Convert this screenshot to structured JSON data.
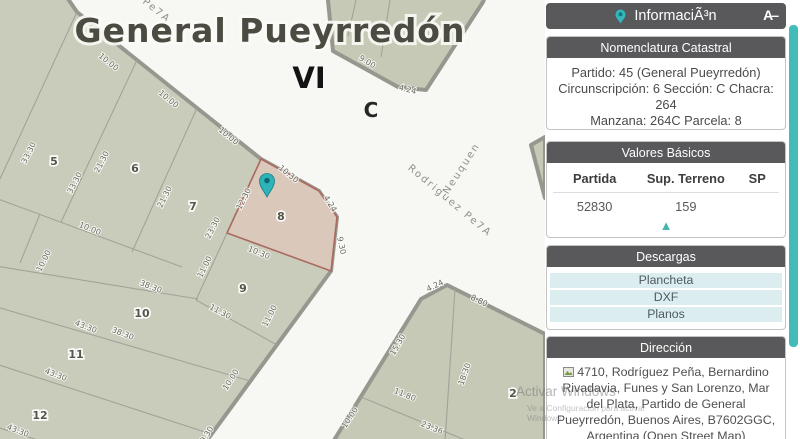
{
  "map": {
    "title": "General Pueyrredón",
    "zone_label": "VI",
    "section_label": "C",
    "streets": [
      "Rodriguez Pe7A",
      "Neuquen",
      "z Pe7A"
    ],
    "parcels": [
      "5",
      "6",
      "7",
      "8",
      "9",
      "10",
      "11",
      "12",
      "2"
    ],
    "dims": [
      "10.00",
      "10.00",
      "10.00",
      "10.30",
      "4.24",
      "9.30",
      "12.30",
      "10.30",
      "23.30",
      "11.00",
      "21.30",
      "21.30",
      "33.30",
      "33.30",
      "10.00",
      "10.00",
      "38.30",
      "38.30",
      "43.30",
      "43.30",
      "43.30",
      "11.30",
      "11.00",
      "10.00",
      "9.30",
      "9.00",
      "4.24",
      "4.24",
      "8.80",
      "15.30",
      "11.80",
      "18.30",
      "23.36",
      "10.00"
    ]
  },
  "sidebar": {
    "header": {
      "title": "InformaciÃ³n",
      "right_icon_glyph": "A–"
    },
    "nomenclatura": {
      "title": "Nomenclatura Catastral",
      "line1": "Partido: 45 (General Pueyrredón)",
      "line2": "Circunscripción: 6 Sección: C Chacra: 264",
      "line3": "Manzana: 264C Parcela: 8",
      "copy_button": "Copiar"
    },
    "valores": {
      "title": "Valores Básicos",
      "headers": [
        "Partida",
        "Sup. Terreno",
        "SP"
      ],
      "row": [
        "52830",
        "159",
        ""
      ],
      "icon_glyph": "▲"
    },
    "descargas": {
      "title": "Descargas",
      "items": [
        "Plancheta",
        "DXF",
        "Planos"
      ]
    },
    "direccion": {
      "title": "Dirección",
      "text": "4710, Rodríguez Peña, Bernardino Rivadavia, Funes y San Lorenzo, Mar del Plata, Partido de General Pueyrredón, Buenos Aires, B7602GGC, Argentina (Open Street Map)"
    }
  },
  "watermark": {
    "line1": "Activar Windows",
    "line2": "Ve a Configuración para activar Windows."
  },
  "colors": {
    "accent_teal": "#45b8b3",
    "header_gray": "#59595b",
    "parcel_fill": "#c9ccba",
    "selected_parcel_fill": "#dac8bb"
  }
}
